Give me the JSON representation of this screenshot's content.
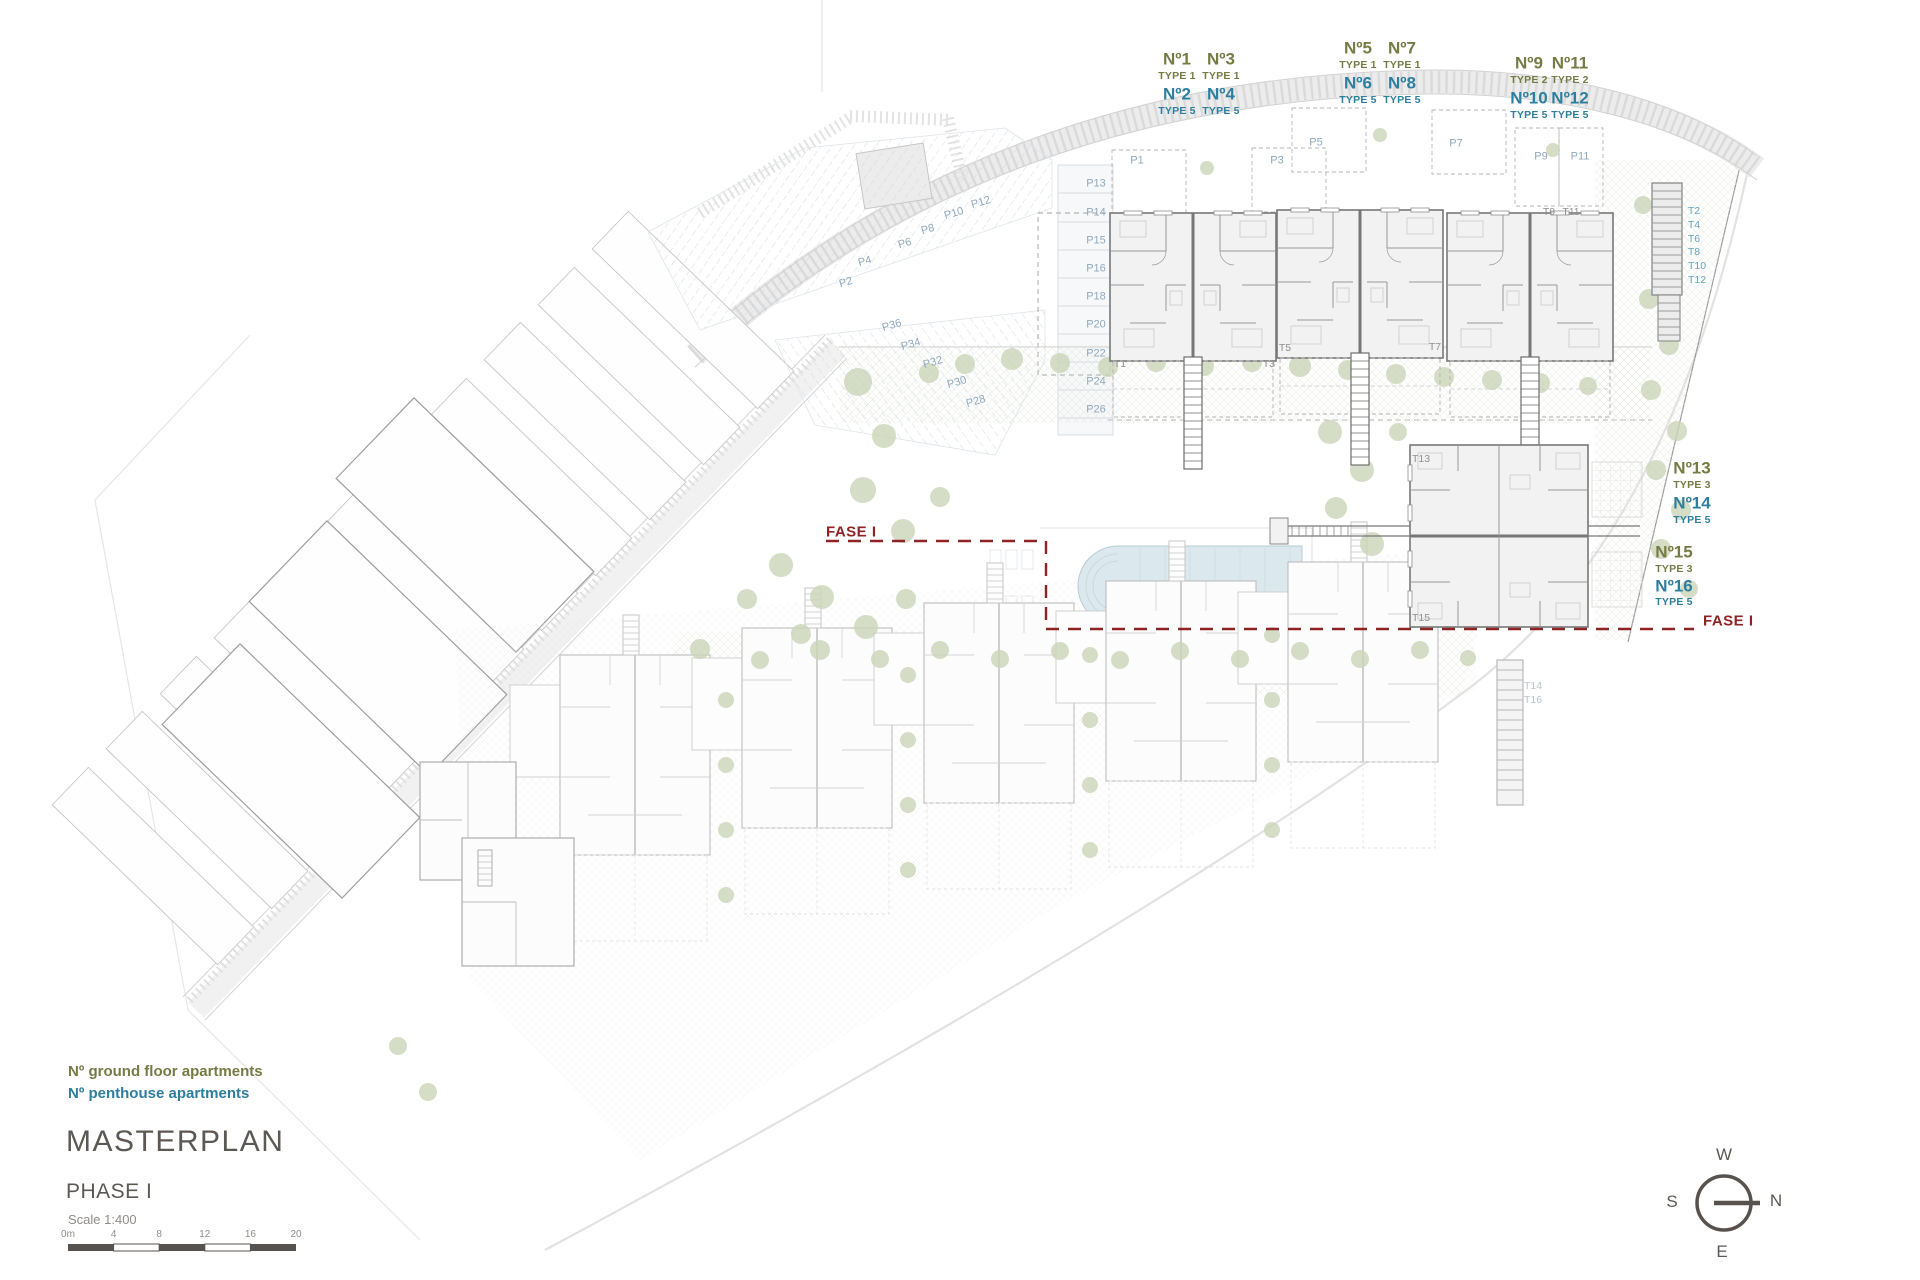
{
  "colors": {
    "ground_floor_text": "#767b45",
    "penthouse_text": "#2e7e9e",
    "parking_text": "#8fa9bf",
    "unit_text_gray": "#8f8f8f",
    "unit_text_teal": "#63a5ba",
    "unit_text_faint": "#b7c5cc",
    "phase_line": "#8e2323",
    "title_text": "#5c5854",
    "muted_text": "#8f8c89",
    "pool_fill": "#dbe8ee",
    "tree_fill": "#cbd5b9",
    "wall_stroke": "#777777"
  },
  "legend": {
    "ground_floor": "Nº ground floor apartments",
    "penthouse": "Nº penthouse apartments"
  },
  "title_block": {
    "title": "MASTERPLAN",
    "phase": "PHASE I",
    "scale": "Scale 1:400",
    "scale_ticks": [
      "0m",
      "4",
      "8",
      "12",
      "16",
      "20"
    ]
  },
  "compass": {
    "top": "W",
    "left": "S",
    "right": "N",
    "bottom": "E"
  },
  "phase_boundary": {
    "left": "FASE I",
    "right": "FASE I"
  },
  "apartment_labels": [
    {
      "t": "Nº1",
      "x": 1177,
      "y": 59,
      "c": "g",
      "s": "b"
    },
    {
      "t": "Nº3",
      "x": 1221,
      "y": 59,
      "c": "g",
      "s": "b"
    },
    {
      "t": "TYPE 1",
      "x": 1177,
      "y": 76,
      "c": "g",
      "s": "s"
    },
    {
      "t": "TYPE 1",
      "x": 1221,
      "y": 76,
      "c": "g",
      "s": "s"
    },
    {
      "t": "Nº2",
      "x": 1177,
      "y": 94,
      "c": "p",
      "s": "b"
    },
    {
      "t": "Nº4",
      "x": 1221,
      "y": 94,
      "c": "p",
      "s": "b"
    },
    {
      "t": "TYPE 5",
      "x": 1177,
      "y": 111,
      "c": "p",
      "s": "s"
    },
    {
      "t": "TYPE 5",
      "x": 1221,
      "y": 111,
      "c": "p",
      "s": "s"
    },
    {
      "t": "Nº5",
      "x": 1358,
      "y": 48,
      "c": "g",
      "s": "b"
    },
    {
      "t": "Nº7",
      "x": 1402,
      "y": 48,
      "c": "g",
      "s": "b"
    },
    {
      "t": "TYPE 1",
      "x": 1358,
      "y": 65,
      "c": "g",
      "s": "s"
    },
    {
      "t": "TYPE 1",
      "x": 1402,
      "y": 65,
      "c": "g",
      "s": "s"
    },
    {
      "t": "Nº6",
      "x": 1358,
      "y": 83,
      "c": "p",
      "s": "b"
    },
    {
      "t": "Nº8",
      "x": 1402,
      "y": 83,
      "c": "p",
      "s": "b"
    },
    {
      "t": "TYPE 5",
      "x": 1358,
      "y": 100,
      "c": "p",
      "s": "s"
    },
    {
      "t": "TYPE 5",
      "x": 1402,
      "y": 100,
      "c": "p",
      "s": "s"
    },
    {
      "t": "Nº9",
      "x": 1529,
      "y": 63,
      "c": "g",
      "s": "b"
    },
    {
      "t": "Nº11",
      "x": 1570,
      "y": 63,
      "c": "g",
      "s": "b"
    },
    {
      "t": "TYPE 2",
      "x": 1529,
      "y": 80,
      "c": "g",
      "s": "s"
    },
    {
      "t": "TYPE 2",
      "x": 1570,
      "y": 80,
      "c": "g",
      "s": "s"
    },
    {
      "t": "Nº10",
      "x": 1529,
      "y": 98,
      "c": "p",
      "s": "b"
    },
    {
      "t": "Nº12",
      "x": 1570,
      "y": 98,
      "c": "p",
      "s": "b"
    },
    {
      "t": "TYPE 5",
      "x": 1529,
      "y": 115,
      "c": "p",
      "s": "s"
    },
    {
      "t": "TYPE 5",
      "x": 1570,
      "y": 115,
      "c": "p",
      "s": "s"
    },
    {
      "t": "Nº13",
      "x": 1692,
      "y": 468,
      "c": "g",
      "s": "b"
    },
    {
      "t": "TYPE 3",
      "x": 1692,
      "y": 485,
      "c": "g",
      "s": "s"
    },
    {
      "t": "Nº14",
      "x": 1692,
      "y": 503,
      "c": "p",
      "s": "b"
    },
    {
      "t": "TYPE 5",
      "x": 1692,
      "y": 520,
      "c": "p",
      "s": "s"
    },
    {
      "t": "Nº15",
      "x": 1674,
      "y": 552,
      "c": "g",
      "s": "b"
    },
    {
      "t": "TYPE 3",
      "x": 1674,
      "y": 569,
      "c": "g",
      "s": "s"
    },
    {
      "t": "Nº16",
      "x": 1674,
      "y": 586,
      "c": "p",
      "s": "b"
    },
    {
      "t": "TYPE 5",
      "x": 1674,
      "y": 602,
      "c": "p",
      "s": "s"
    }
  ],
  "parking_labels": [
    {
      "t": "P2",
      "x": 846,
      "y": 283,
      "r": -16
    },
    {
      "t": "P4",
      "x": 865,
      "y": 262,
      "r": -16
    },
    {
      "t": "P6",
      "x": 905,
      "y": 244,
      "r": -16
    },
    {
      "t": "P8",
      "x": 928,
      "y": 230,
      "r": -16
    },
    {
      "t": "P10",
      "x": 954,
      "y": 214,
      "r": -16
    },
    {
      "t": "P12",
      "x": 981,
      "y": 203,
      "r": -16
    },
    {
      "t": "P36",
      "x": 892,
      "y": 326,
      "r": -16
    },
    {
      "t": "P34",
      "x": 911,
      "y": 345,
      "r": -16
    },
    {
      "t": "P32",
      "x": 933,
      "y": 363,
      "r": -16
    },
    {
      "t": "P30",
      "x": 957,
      "y": 383,
      "r": -16
    },
    {
      "t": "P28",
      "x": 976,
      "y": 402,
      "r": -16
    },
    {
      "t": "P13",
      "x": 1096,
      "y": 184,
      "r": 0
    },
    {
      "t": "P14",
      "x": 1096,
      "y": 213,
      "r": 0
    },
    {
      "t": "P15",
      "x": 1096,
      "y": 241,
      "r": 0
    },
    {
      "t": "P16",
      "x": 1096,
      "y": 269,
      "r": 0
    },
    {
      "t": "P18",
      "x": 1096,
      "y": 297,
      "r": 0
    },
    {
      "t": "P20",
      "x": 1096,
      "y": 325,
      "r": 0
    },
    {
      "t": "P22",
      "x": 1096,
      "y": 354,
      "r": 0
    },
    {
      "t": "P24",
      "x": 1096,
      "y": 382,
      "r": 0
    },
    {
      "t": "P26",
      "x": 1096,
      "y": 410,
      "r": 0
    },
    {
      "t": "P1",
      "x": 1137,
      "y": 161,
      "r": 0
    },
    {
      "t": "P3",
      "x": 1277,
      "y": 161,
      "r": 0
    },
    {
      "t": "P5",
      "x": 1316,
      "y": 143,
      "r": 0
    },
    {
      "t": "P7",
      "x": 1456,
      "y": 144,
      "r": 0
    },
    {
      "t": "P9",
      "x": 1541,
      "y": 157,
      "r": 0
    },
    {
      "t": "P11",
      "x": 1580,
      "y": 157,
      "r": 0
    }
  ],
  "unit_labels": [
    {
      "t": "T1",
      "x": 1120,
      "y": 364,
      "tone": "gray"
    },
    {
      "t": "T3",
      "x": 1269,
      "y": 364,
      "tone": "gray"
    },
    {
      "t": "T5",
      "x": 1285,
      "y": 348,
      "tone": "gray"
    },
    {
      "t": "T7",
      "x": 1435,
      "y": 347,
      "tone": "gray"
    },
    {
      "t": "T9",
      "x": 1549,
      "y": 212,
      "tone": "gray"
    },
    {
      "t": "T11",
      "x": 1571,
      "y": 212,
      "tone": "gray"
    },
    {
      "t": "T13",
      "x": 1421,
      "y": 459,
      "tone": "gray"
    },
    {
      "t": "T15",
      "x": 1421,
      "y": 618,
      "tone": "gray"
    },
    {
      "t": "T2",
      "x": 1694,
      "y": 211,
      "tone": "teal"
    },
    {
      "t": "T4",
      "x": 1694,
      "y": 225,
      "tone": "teal"
    },
    {
      "t": "T6",
      "x": 1694,
      "y": 239,
      "tone": "teal"
    },
    {
      "t": "T8",
      "x": 1694,
      "y": 252,
      "tone": "teal"
    },
    {
      "t": "T10",
      "x": 1697,
      "y": 266,
      "tone": "teal"
    },
    {
      "t": "T12",
      "x": 1697,
      "y": 280,
      "tone": "teal"
    },
    {
      "t": "T14",
      "x": 1533,
      "y": 686,
      "tone": "faint"
    },
    {
      "t": "T16",
      "x": 1533,
      "y": 700,
      "tone": "faint"
    }
  ]
}
